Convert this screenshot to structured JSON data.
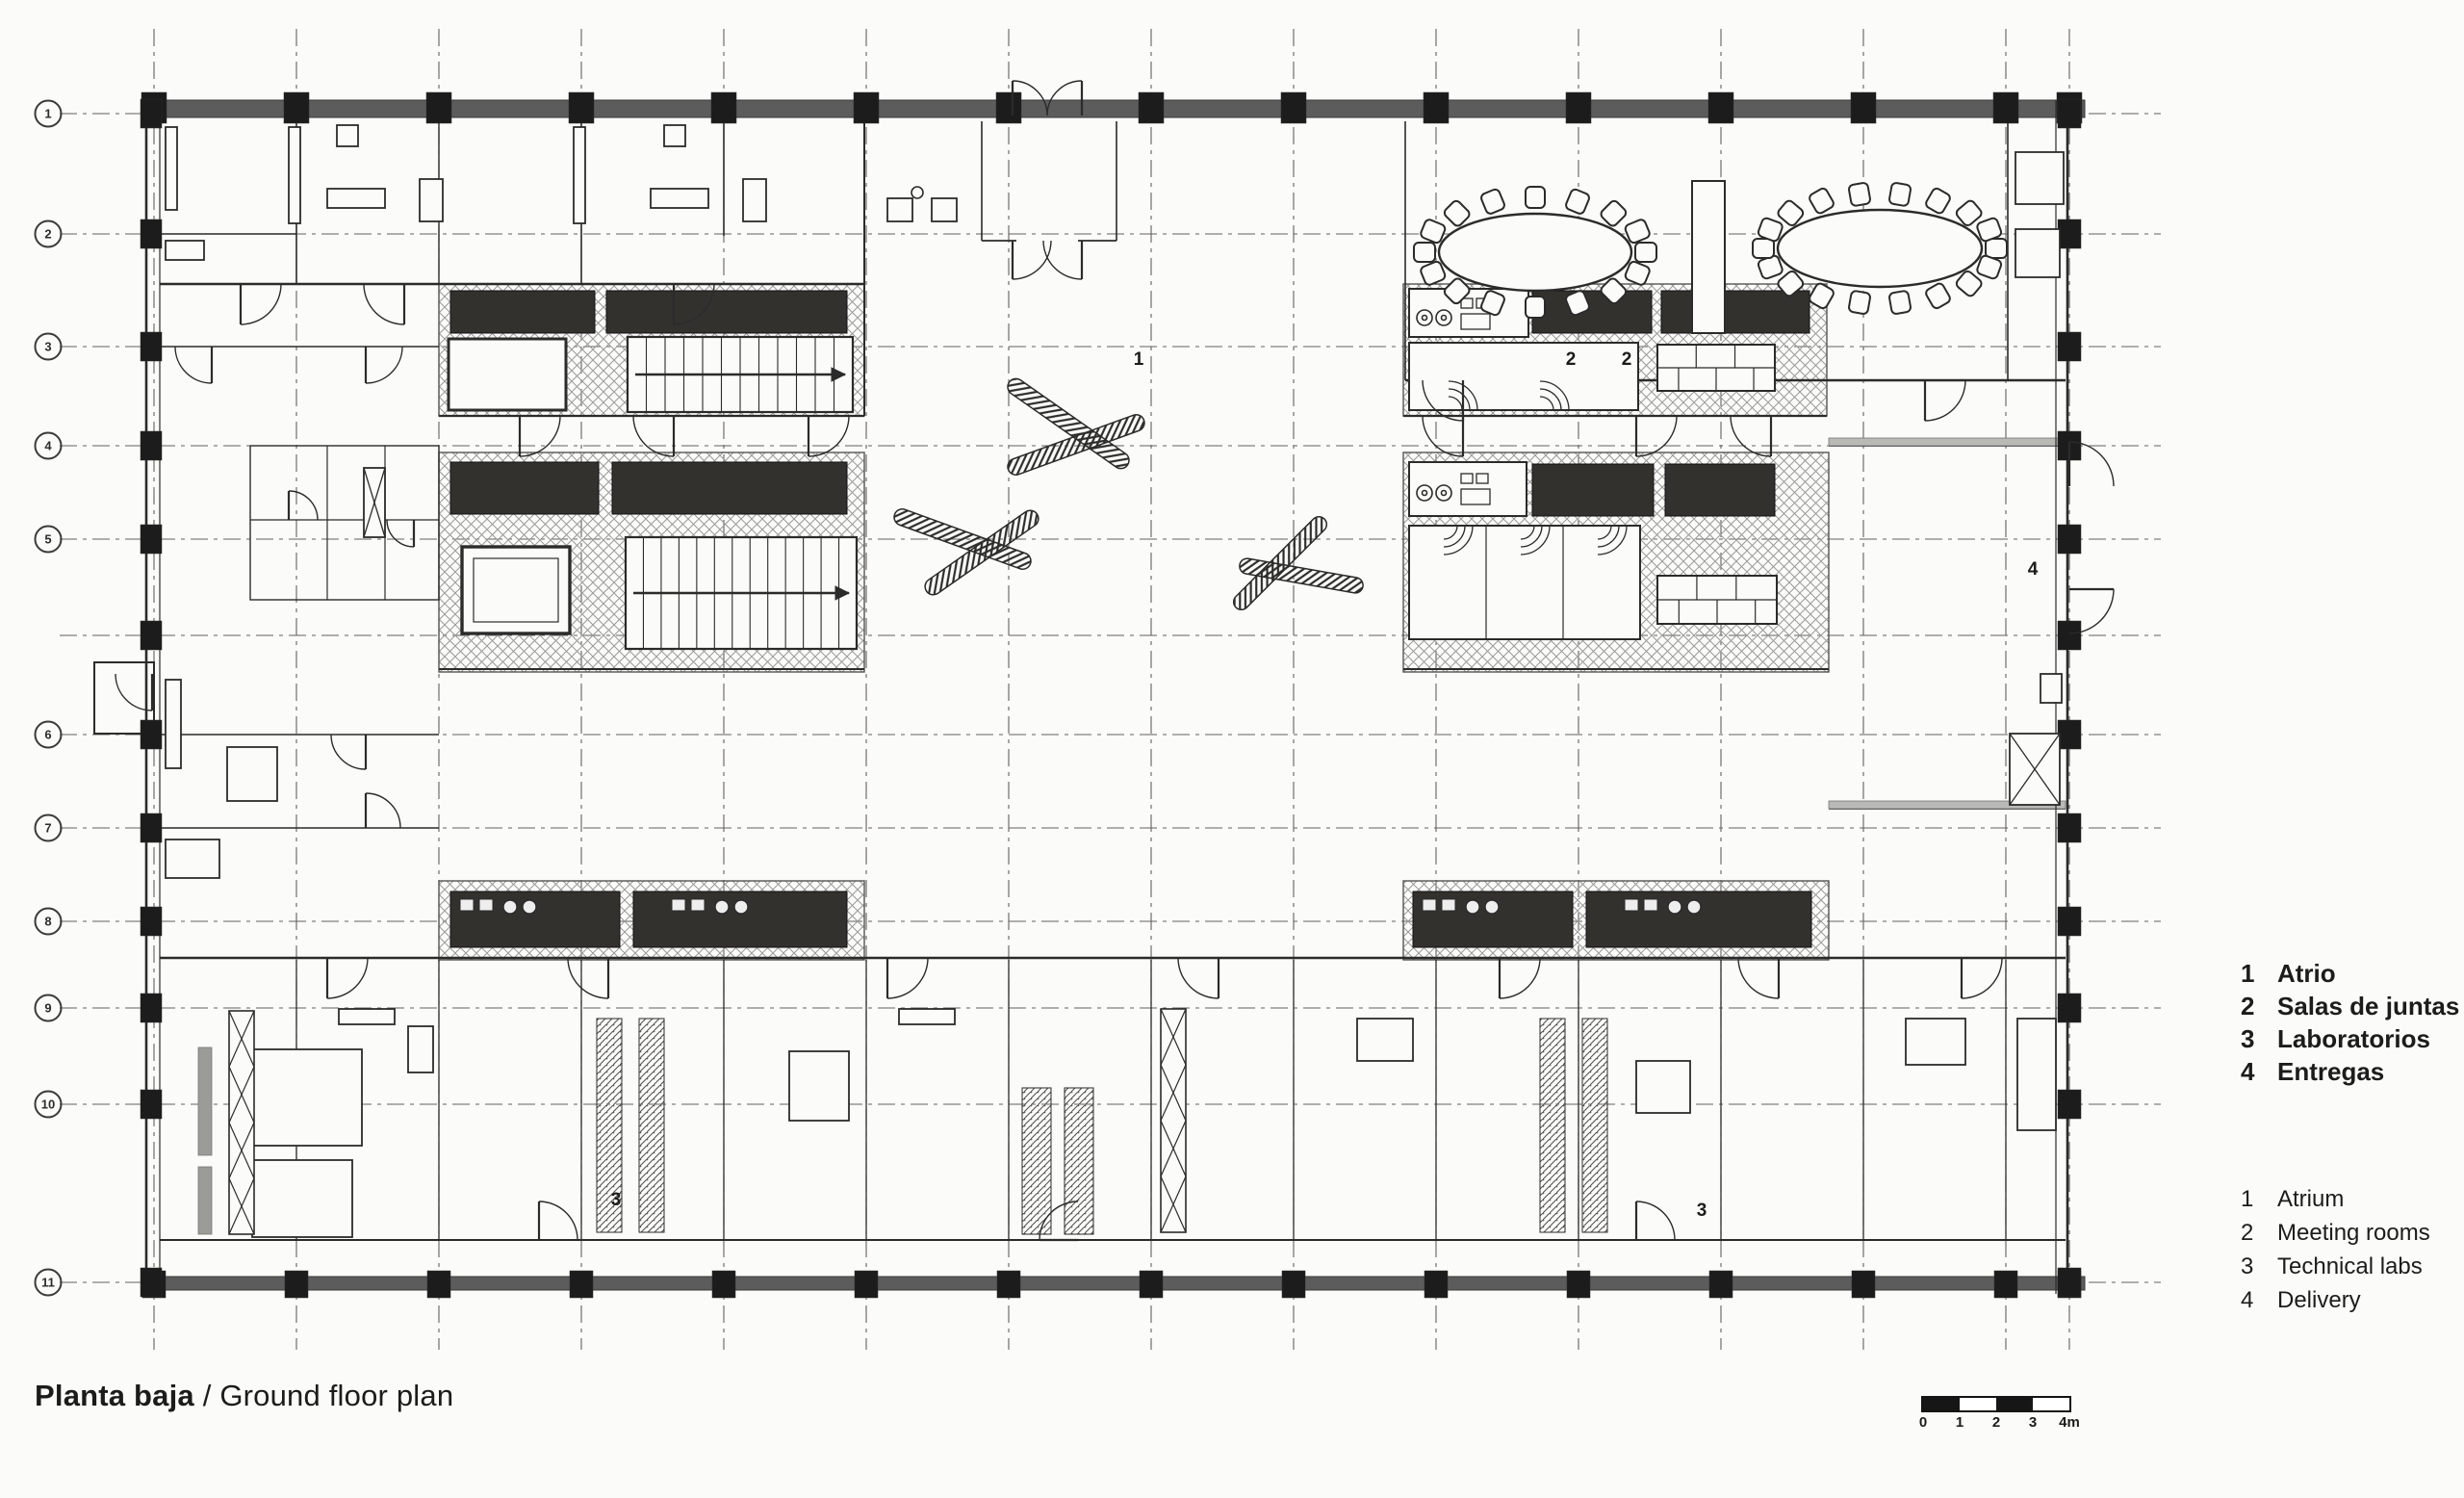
{
  "title": {
    "bold": "Planta baja",
    "separator": " / ",
    "regular": "Ground floor plan"
  },
  "legend_spanish": {
    "items": [
      {
        "num": "1",
        "label": "Atrio"
      },
      {
        "num": "2",
        "label": "Salas de juntas"
      },
      {
        "num": "3",
        "label": "Laboratorios"
      },
      {
        "num": "4",
        "label": "Entregas"
      }
    ]
  },
  "legend_english": {
    "items": [
      {
        "num": "1",
        "label": "Atrium"
      },
      {
        "num": "2",
        "label": "Meeting rooms"
      },
      {
        "num": "3",
        "label": "Technical labs"
      },
      {
        "num": "4",
        "label": "Delivery"
      }
    ]
  },
  "scale_bar": {
    "tick_labels": [
      "0",
      "1",
      "2",
      "3",
      "4m"
    ],
    "segment_colors": [
      "#161616",
      "#ffffff",
      "#161616",
      "#ffffff"
    ]
  },
  "grid_bubbles": {
    "labels": [
      "1",
      "2",
      "3",
      "4",
      "5",
      "6",
      "7",
      "8",
      "9",
      "10",
      "11"
    ]
  },
  "plan_zone_labels": [
    {
      "id": "atrium",
      "text": "1"
    },
    {
      "id": "meeting-room-a",
      "text": "2"
    },
    {
      "id": "meeting-room-b",
      "text": "2"
    },
    {
      "id": "labs-left",
      "text": "3"
    },
    {
      "id": "labs-right",
      "text": "3"
    },
    {
      "id": "delivery",
      "text": "4"
    }
  ],
  "drawing_colors": {
    "ink": "#2b2b2b",
    "dark_fill": "#33312e",
    "facade_gray": "#5c5c5c",
    "hatch_gray": "#9a9a98",
    "paper": "#fbfbf9"
  }
}
